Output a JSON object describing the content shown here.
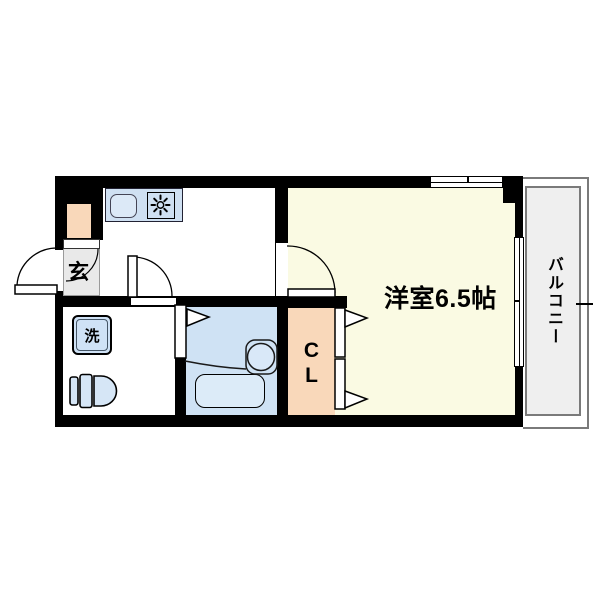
{
  "floorplan": {
    "rooms": {
      "entrance": {
        "label": "玄"
      },
      "laundry": {
        "label": "洗"
      },
      "closet": {
        "label_line1": "C",
        "label_line2": "L"
      },
      "main_room": {
        "label": "洋室6.5帖"
      },
      "balcony": {
        "label": "バルコニー"
      }
    },
    "colors": {
      "wall": "#000000",
      "main_room_fill": "#FAFAE3",
      "bathroom_fill": "#CFE2F4",
      "bathtub_fill": "#DCEBF8",
      "closet_fill": "#F9D8BA",
      "shoe_cabinet_fill": "#F9D8BA",
      "entrance_fill": "#E9E9E9",
      "kitchen_counter_fill": "#CFE0F2",
      "sink_fill": "#DCE9F7",
      "fixture_fill": "#D6E6F6",
      "balcony_fill": "#EFEFEF",
      "balcony_border": "#7A7A7A"
    },
    "icons": [
      "sink-icon",
      "stove-burner-icon",
      "washing-machine-icon",
      "toilet-icon",
      "bathtub-icon",
      "basin-icon",
      "door-swing-icon",
      "folding-door-icon",
      "window-icon"
    ]
  }
}
